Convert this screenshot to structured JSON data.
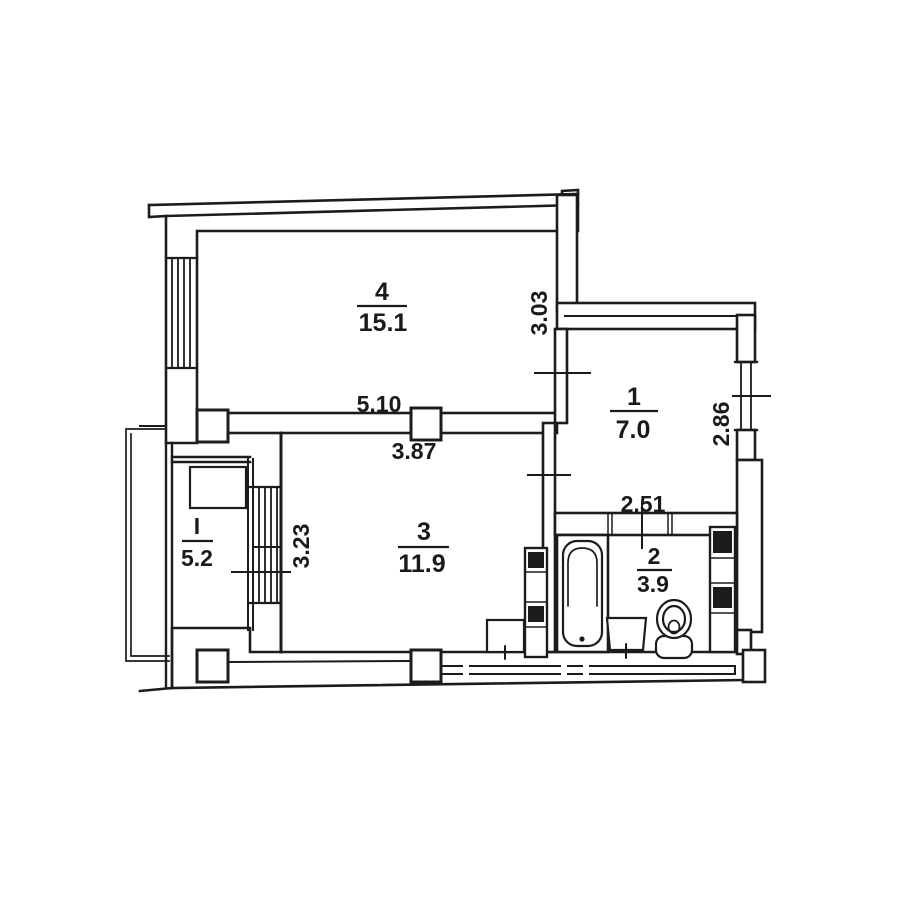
{
  "title": "apartment-floor-plan",
  "rooms": [
    {
      "number": "4",
      "area": "15.1"
    },
    {
      "number": "1",
      "area": "7.0"
    },
    {
      "number": "3",
      "area": "11.9"
    },
    {
      "number": "2",
      "area": "3.9"
    },
    {
      "number": "I",
      "area": "5.2"
    }
  ],
  "dimensions": [
    {
      "label": "5.10",
      "orientation": "horizontal"
    },
    {
      "label": "3.87",
      "orientation": "horizontal"
    },
    {
      "label": "3.03",
      "orientation": "vertical"
    },
    {
      "label": "2.86",
      "orientation": "vertical"
    },
    {
      "label": "2.51",
      "orientation": "horizontal"
    },
    {
      "label": "3.23",
      "orientation": "vertical"
    }
  ],
  "fixtures": [
    "bathtub",
    "toilet",
    "washbasin",
    "sink-cabinet",
    "ventilation-shaft",
    "ventilation-shaft"
  ],
  "colors": {
    "ink": "#1c1c1c",
    "paper": "#ffffff"
  }
}
